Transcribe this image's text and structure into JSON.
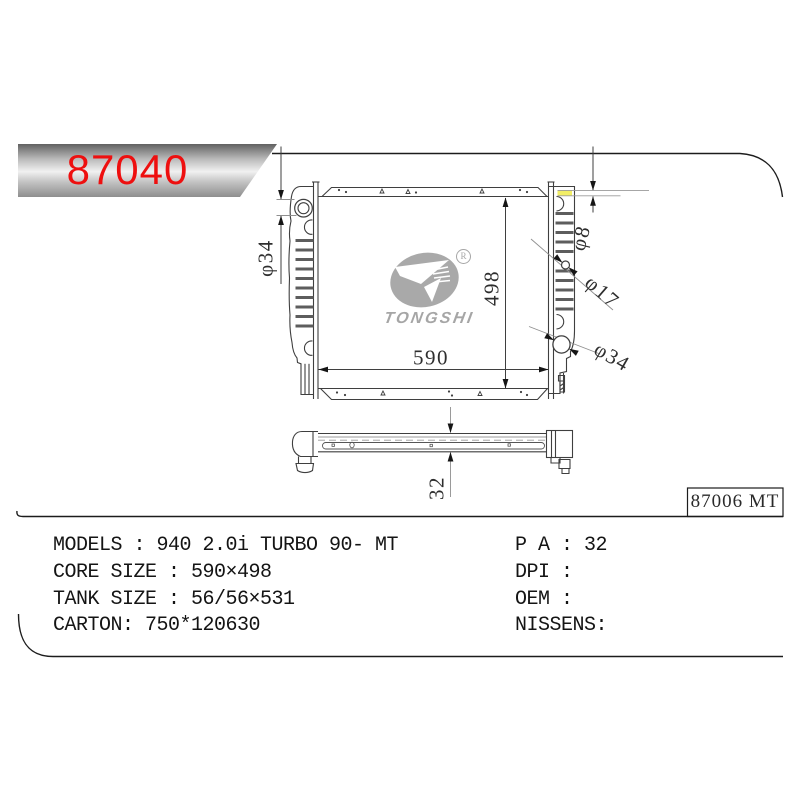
{
  "banner": {
    "part_number": "87040",
    "accent_red": "#ee0f0f"
  },
  "drawing": {
    "dimensions": {
      "filler_neck_diameter": "φ34",
      "core_height": "498",
      "core_width": "590",
      "overflow_tube_diameter": "φ8",
      "inlet_diameter": "φ17",
      "outlet_diameter": "φ34",
      "bottom_thickness": "32"
    },
    "watermark": {
      "brand": "TONGSHI",
      "registered_symbol": "R"
    },
    "ref_code": "87006 MT",
    "highlight_yellow": "#f2ee66",
    "line_color": "#3f3f3f"
  },
  "specs": {
    "left": [
      "MODELS : 940 2.0i TURBO 90- MT",
      "CORE SIZE : 590×498",
      "TANK SIZE : 56/56×531",
      "CARTON: 750*120630"
    ],
    "right": [
      "P A : 32",
      "DPI :",
      "OEM :",
      "NISSENS:"
    ]
  }
}
